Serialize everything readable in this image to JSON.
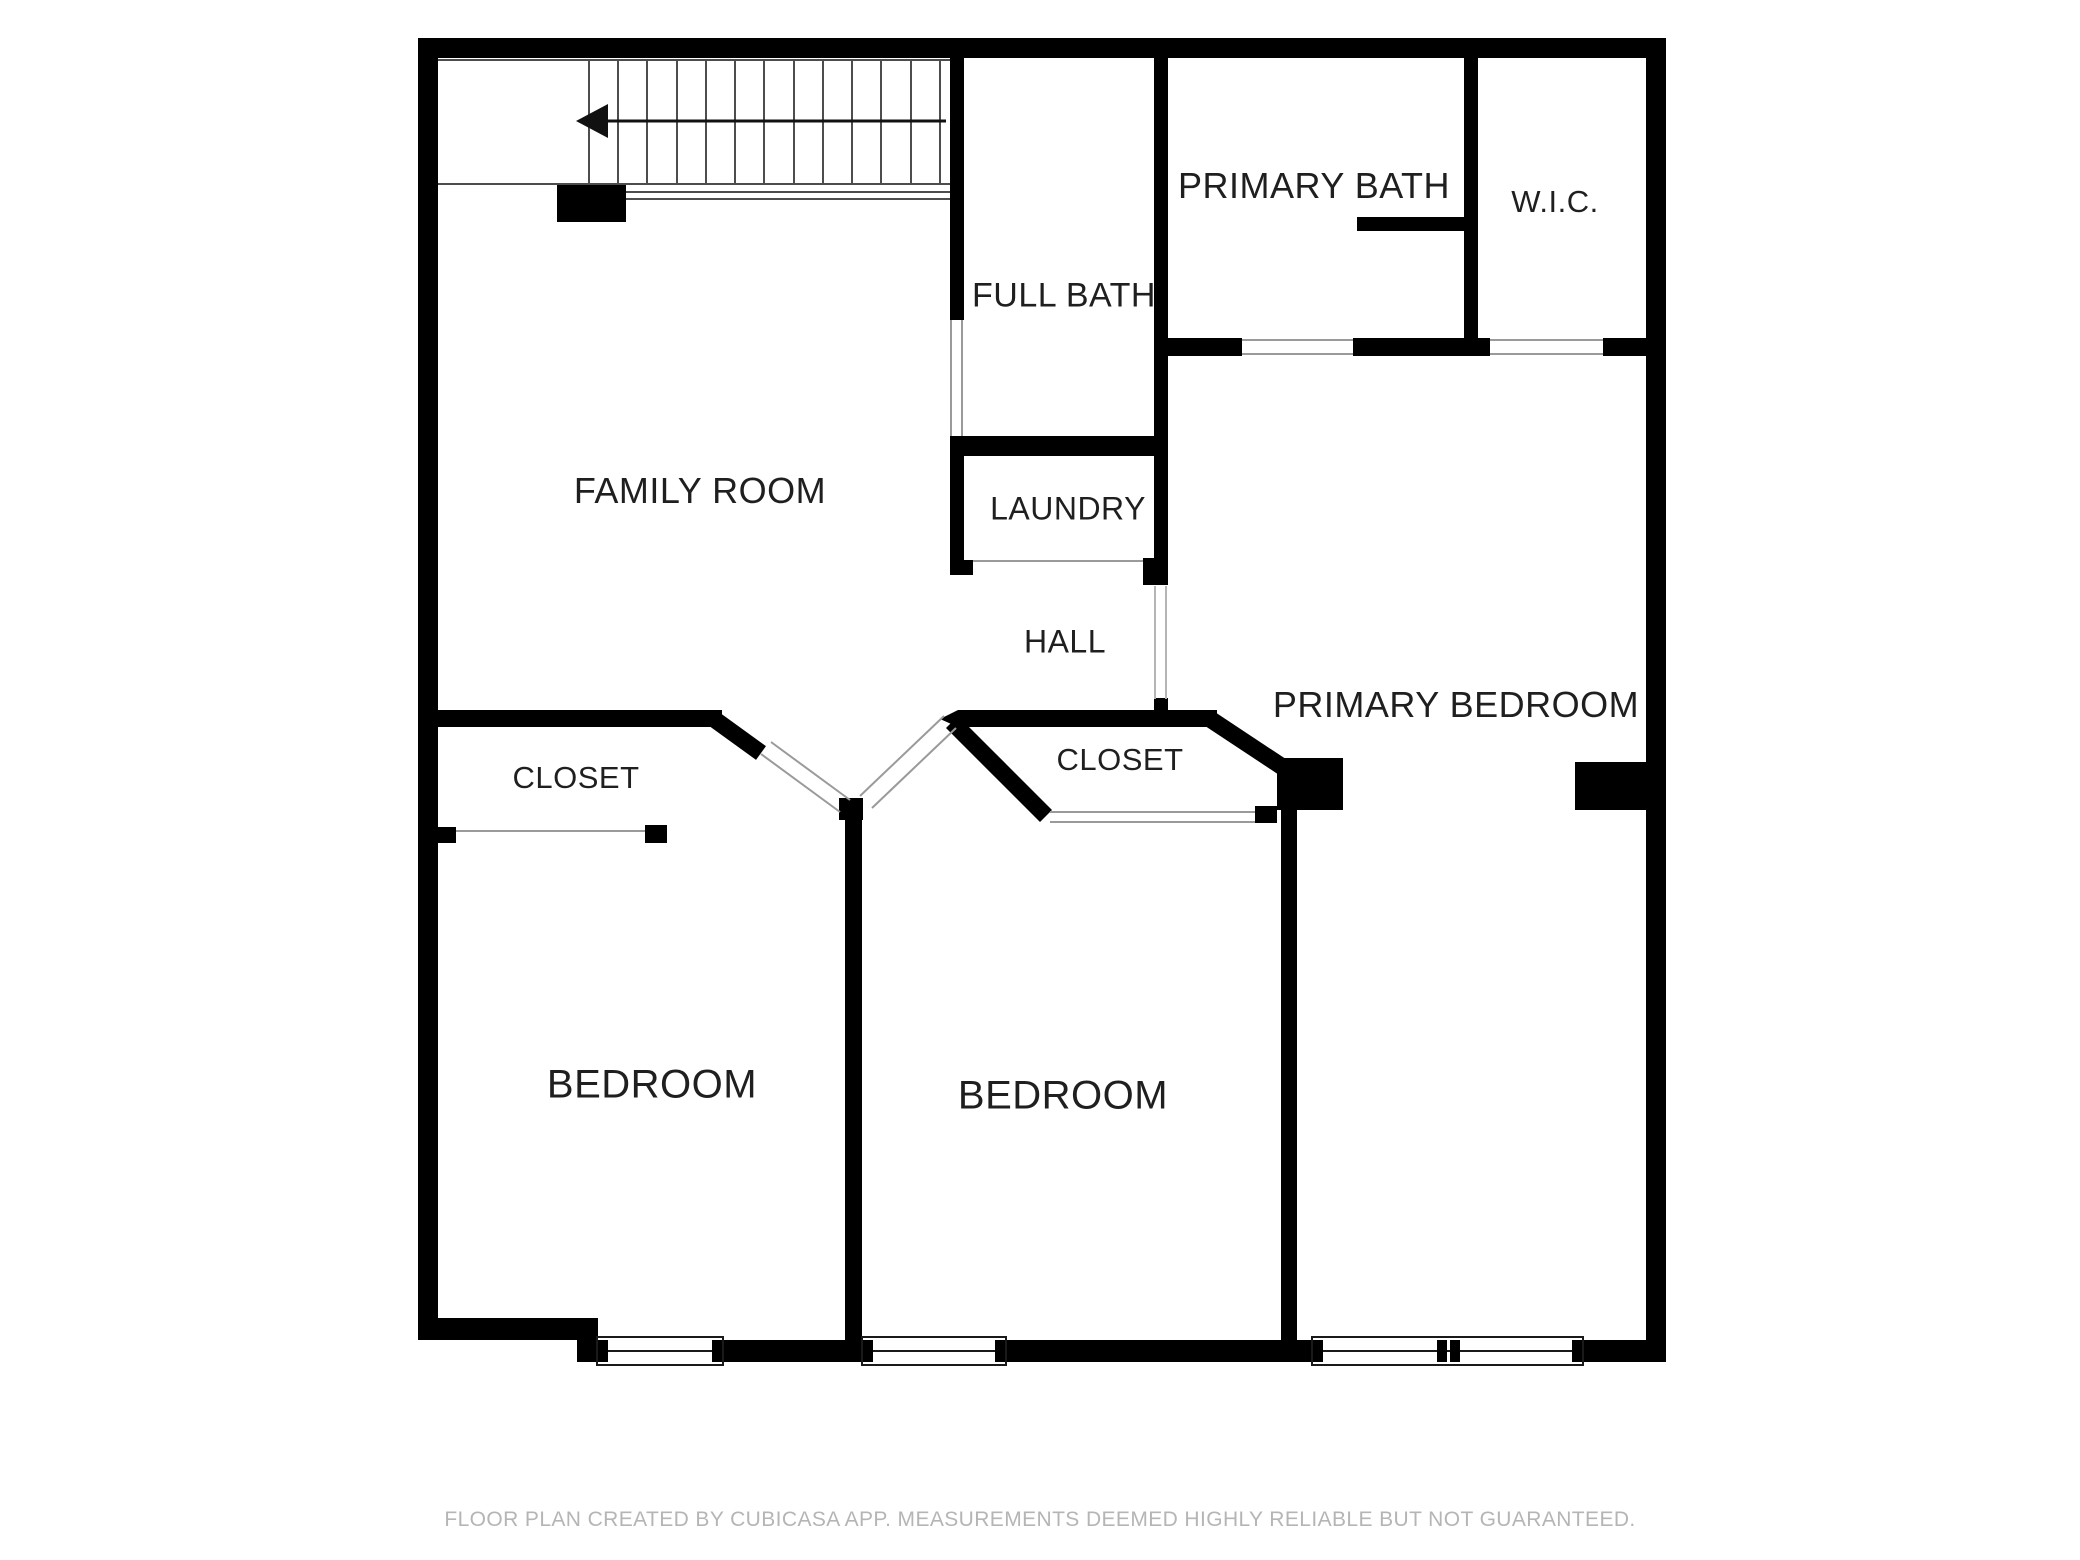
{
  "plan": {
    "rooms": {
      "family_room": "FAMILY ROOM",
      "full_bath": "FULL BATH",
      "primary_bath": "PRIMARY BATH",
      "wic": "W.I.C.",
      "laundry": "LAUNDRY",
      "hall": "HALL",
      "primary_bedroom": "PRIMARY BEDROOM",
      "closet_left": "CLOSET",
      "closet_right": "CLOSET",
      "bedroom_left": "BEDROOM",
      "bedroom_right": "BEDROOM"
    },
    "icons": {
      "stair_direction": "arrow-left"
    },
    "colors": {
      "wall": "#000000",
      "background": "#ffffff",
      "label_text": "#1f1f1f",
      "footer_text": "#b5b5b5",
      "stair_line": "#4d4d4d",
      "opening_line": "#9a9a9a"
    },
    "footer": {
      "disclaimer": "FLOOR PLAN CREATED BY CUBICASA APP. MEASUREMENTS DEEMED HIGHLY RELIABLE BUT NOT GUARANTEED."
    }
  }
}
